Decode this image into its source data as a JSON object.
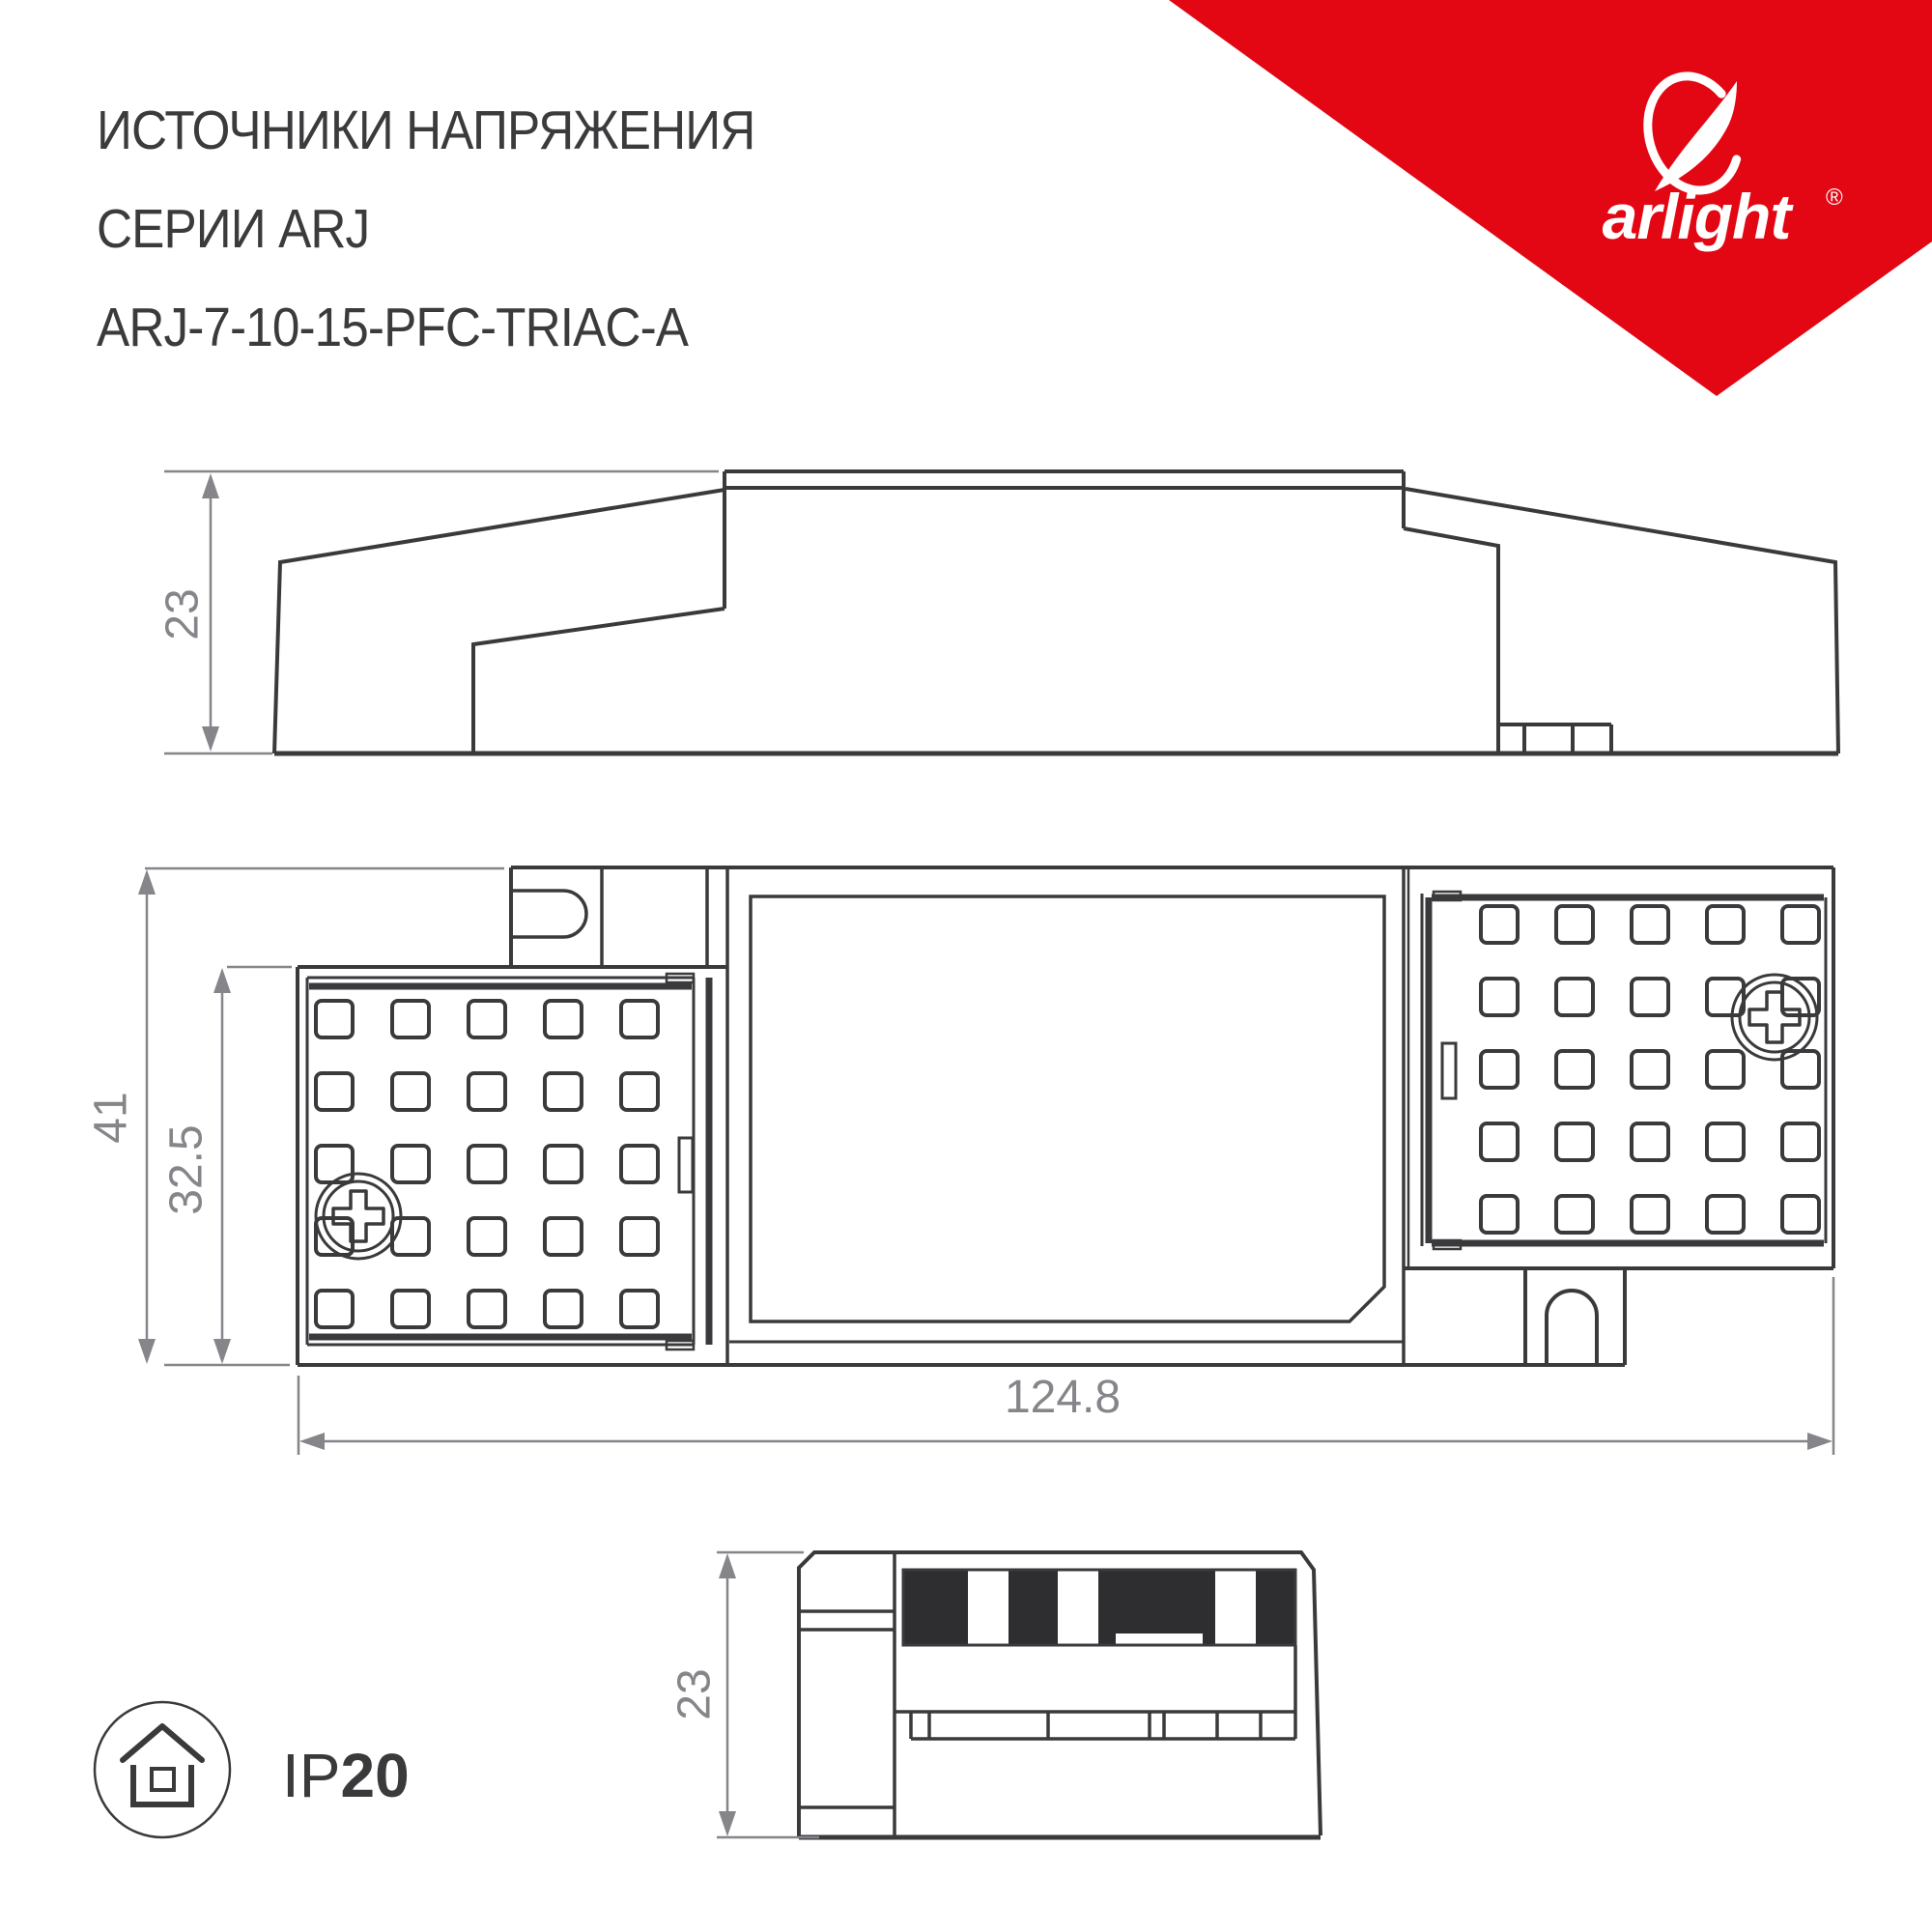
{
  "header": {
    "title_lines": [
      "ИСТОЧНИКИ НАПРЯЖЕНИЯ",
      "СЕРИИ ARJ",
      "ARJ-7-10-15-PFC-TRIAC-A"
    ]
  },
  "logo": {
    "brand": "arlight",
    "registered": "®"
  },
  "colors": {
    "accent_red": "#e30613",
    "line_dark": "#3a3a3c",
    "dim_gray": "#85858a"
  },
  "views": {
    "side": {
      "label": "side-profile-view",
      "height_dim": "23"
    },
    "plan": {
      "label": "top-plan-view",
      "height_dim": "41",
      "inner_height_dim": "32.5",
      "length_dim": "124.8"
    },
    "end": {
      "label": "end-view",
      "height_dim": "23"
    }
  },
  "footer": {
    "ip_prefix": "IP",
    "ip_value": "20",
    "ip_icon": "house-in-circle-icon"
  }
}
